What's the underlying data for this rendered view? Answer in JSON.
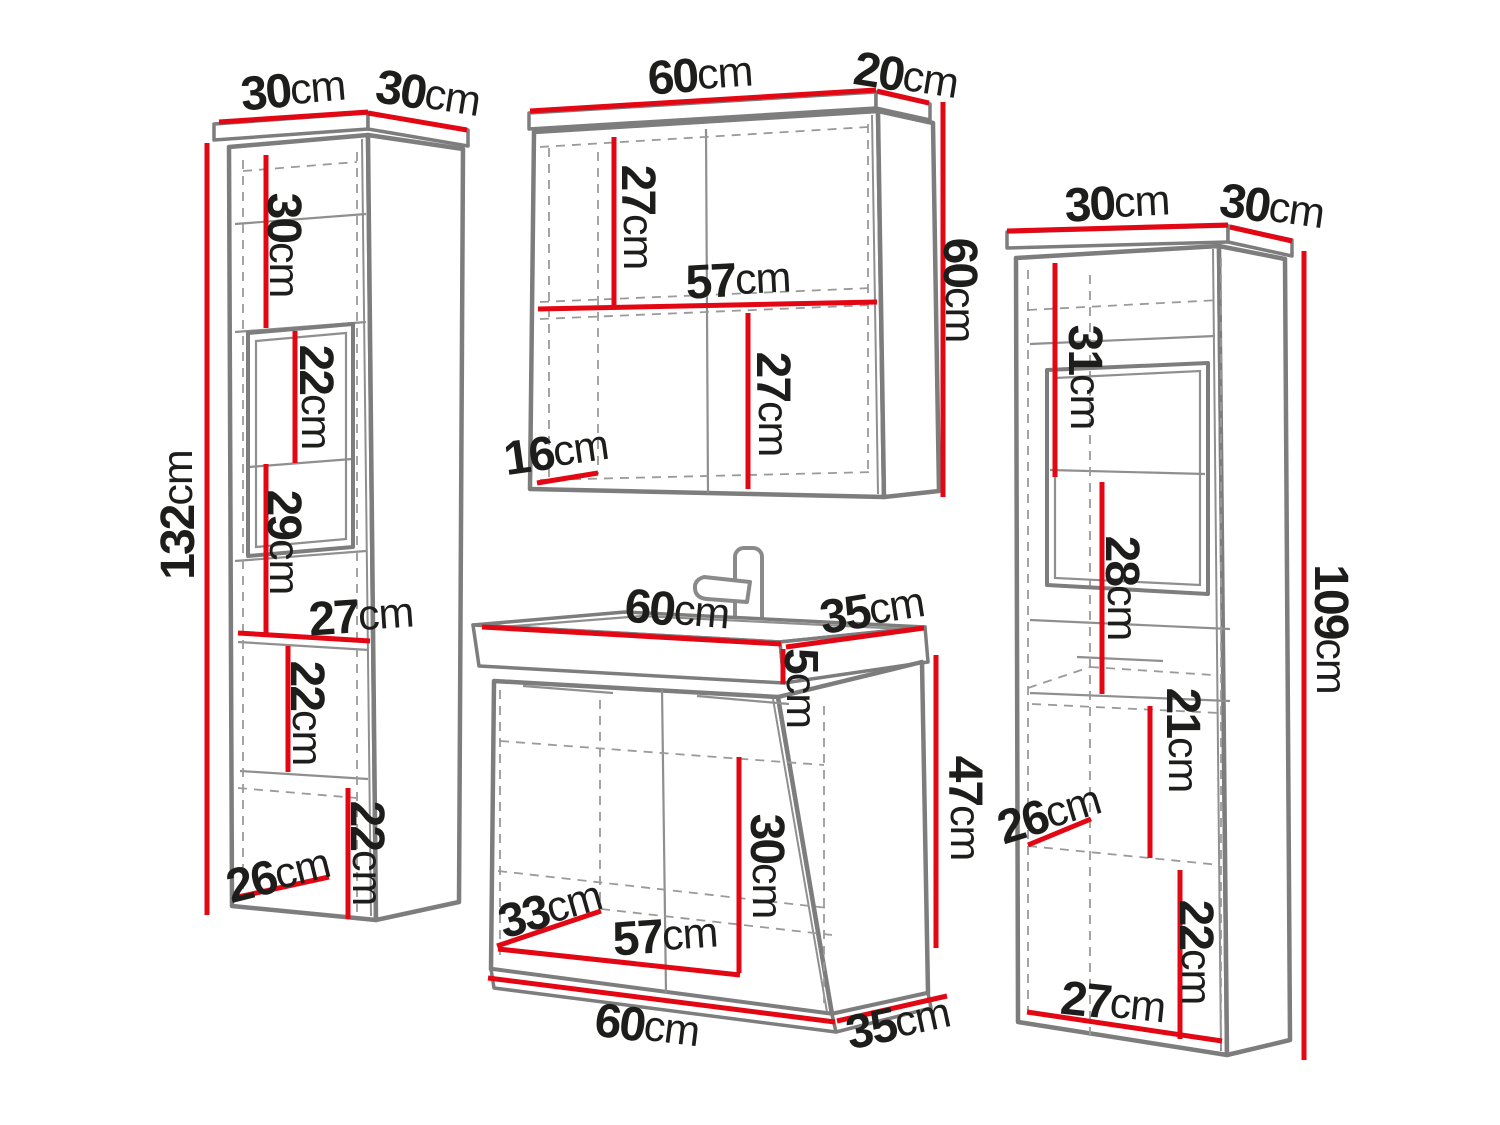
{
  "diagram": {
    "type": "furniture-dimension-diagram",
    "subject": "bathroom furniture set (tall cabinet, mirror cabinet, sink vanity, tall cabinet)",
    "unit": "cm",
    "colors": {
      "measurement_line": "#e30613",
      "outline": "#7d7d7d",
      "outline_thin": "#8f8f8f",
      "dashed_line": "#9a9a9a",
      "label_text": "#1d1d1b",
      "background": "#ffffff"
    }
  },
  "pieces": [
    {
      "id": "tall-cabinet-left",
      "labels": [
        {
          "value": "30",
          "unit": "cm",
          "x": 293,
          "y": 90,
          "rot": -5
        },
        {
          "value": "30",
          "unit": "cm",
          "x": 428,
          "y": 94,
          "rot": 9
        },
        {
          "value": "30",
          "unit": "cm",
          "x": 284,
          "y": 245,
          "rot": 90
        },
        {
          "value": "22",
          "unit": "cm",
          "x": 316,
          "y": 397,
          "rot": 90
        },
        {
          "value": "29",
          "unit": "cm",
          "x": 284,
          "y": 542,
          "rot": 90
        },
        {
          "value": "27",
          "unit": "cm",
          "x": 361,
          "y": 616,
          "rot": -4
        },
        {
          "value": "22",
          "unit": "cm",
          "x": 307,
          "y": 713,
          "rot": 90
        },
        {
          "value": "22",
          "unit": "cm",
          "x": 367,
          "y": 853,
          "rot": 90
        },
        {
          "value": "26",
          "unit": "cm",
          "x": 278,
          "y": 875,
          "rot": -14
        },
        {
          "value": "132",
          "unit": "cm",
          "x": 178,
          "y": 515,
          "rot": -90
        }
      ]
    },
    {
      "id": "mirror-cabinet",
      "labels": [
        {
          "value": "60",
          "unit": "cm",
          "x": 700,
          "y": 75,
          "rot": -4
        },
        {
          "value": "20",
          "unit": "cm",
          "x": 906,
          "y": 76,
          "rot": 9
        },
        {
          "value": "27",
          "unit": "cm",
          "x": 638,
          "y": 217,
          "rot": 90
        },
        {
          "value": "57",
          "unit": "cm",
          "x": 738,
          "y": 280,
          "rot": -3
        },
        {
          "value": "27",
          "unit": "cm",
          "x": 773,
          "y": 404,
          "rot": 90
        },
        {
          "value": "16",
          "unit": "cm",
          "x": 556,
          "y": 452,
          "rot": -8
        },
        {
          "value": "60",
          "unit": "cm",
          "x": 960,
          "y": 290,
          "rot": 90
        }
      ]
    },
    {
      "id": "sink-vanity",
      "labels": [
        {
          "value": "60",
          "unit": "cm",
          "x": 677,
          "y": 610,
          "rot": 5
        },
        {
          "value": "35",
          "unit": "cm",
          "x": 872,
          "y": 610,
          "rot": -9
        },
        {
          "value": "5",
          "unit": "cm",
          "x": 801,
          "y": 688,
          "rot": 90
        },
        {
          "value": "47",
          "unit": "cm",
          "x": 965,
          "y": 808,
          "rot": 90
        },
        {
          "value": "30",
          "unit": "cm",
          "x": 767,
          "y": 866,
          "rot": 90
        },
        {
          "value": "33",
          "unit": "cm",
          "x": 550,
          "y": 909,
          "rot": -16
        },
        {
          "value": "57",
          "unit": "cm",
          "x": 665,
          "y": 936,
          "rot": -4
        },
        {
          "value": "60",
          "unit": "cm",
          "x": 647,
          "y": 1026,
          "rot": 7
        },
        {
          "value": "35",
          "unit": "cm",
          "x": 898,
          "y": 1023,
          "rot": -12
        }
      ]
    },
    {
      "id": "tall-cabinet-right",
      "labels": [
        {
          "value": "30",
          "unit": "cm",
          "x": 1117,
          "y": 203,
          "rot": -3
        },
        {
          "value": "30",
          "unit": "cm",
          "x": 1272,
          "y": 207,
          "rot": 8
        },
        {
          "value": "31",
          "unit": "cm",
          "x": 1085,
          "y": 377,
          "rot": 90
        },
        {
          "value": "28",
          "unit": "cm",
          "x": 1122,
          "y": 588,
          "rot": 90
        },
        {
          "value": "21",
          "unit": "cm",
          "x": 1183,
          "y": 740,
          "rot": 90
        },
        {
          "value": "26",
          "unit": "cm",
          "x": 1049,
          "y": 814,
          "rot": -17
        },
        {
          "value": "22",
          "unit": "cm",
          "x": 1196,
          "y": 952,
          "rot": 90
        },
        {
          "value": "27",
          "unit": "cm",
          "x": 1113,
          "y": 1003,
          "rot": 6
        },
        {
          "value": "109",
          "unit": "cm",
          "x": 1331,
          "y": 629,
          "rot": 90
        }
      ]
    }
  ]
}
